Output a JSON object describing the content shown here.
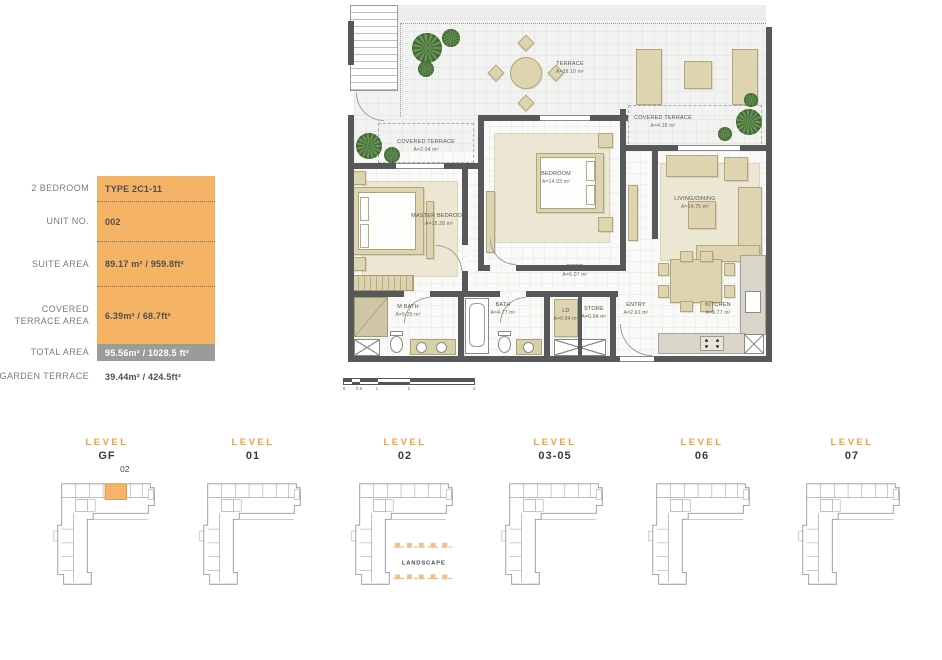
{
  "colors": {
    "table_orange": "#F5B365",
    "total_gray": "#9B9B9B",
    "wall": "#57585A",
    "furniture": "#DED5B0",
    "level_title_orange": "#EBA23B",
    "keyplan_outline": "#8E99AA",
    "highlight_unit": "#F4B56A"
  },
  "spec_table": {
    "rows": [
      {
        "label": "2 BEDROOM",
        "value": "TYPE 2C1-11"
      },
      {
        "label": "UNIT NO.",
        "value": "002"
      },
      {
        "label": "SUITE AREA",
        "value": "89.17 m² / 959.8ft²"
      },
      {
        "label": "COVERED TERRACE AREA",
        "value": "6.39m² / 68.7ft²"
      },
      {
        "label": "TOTAL AREA",
        "value": "95.56m² / 1028.5 ft²"
      },
      {
        "label": "GARDEN TERRACE",
        "value": "39.44m² / 424.5ft²"
      }
    ]
  },
  "floor_plan": {
    "rooms": [
      {
        "name": "TERRACE",
        "area": "A=38.10 m²"
      },
      {
        "name": "COVERED TERRACE",
        "area": "A=2.04 m²"
      },
      {
        "name": "COVERED TERRACE",
        "area": "A=4.35 m²"
      },
      {
        "name": "MASTER BEDROOM",
        "area": "A=15.28 m²"
      },
      {
        "name": "BEDROOM",
        "area": "A=14.03 m²"
      },
      {
        "name": "LIVING/DINING",
        "area": "A=14.75 m²"
      },
      {
        "name": "CORR",
        "area": "A=6.07 m²"
      },
      {
        "name": "M BATH",
        "area": "A=5.25 m²"
      },
      {
        "name": "BATH",
        "area": "A=4.77 m²"
      },
      {
        "name": "LD",
        "area": "A=0.94 m²"
      },
      {
        "name": "STORE",
        "area": "A=0.94 m²"
      },
      {
        "name": "ENTRY",
        "area": "A=2.61 m²"
      },
      {
        "name": "KITCHEN",
        "area": "A=9.77 m²"
      }
    ],
    "scale_ticks": [
      "0",
      "0.5",
      "1",
      "2",
      "4"
    ]
  },
  "levels": [
    {
      "title": "LEVEL",
      "number": "GF",
      "unit": "02"
    },
    {
      "title": "LEVEL",
      "number": "01"
    },
    {
      "title": "LEVEL",
      "number": "02",
      "landscape": "LANDSCAPE"
    },
    {
      "title": "LEVEL",
      "number": "03-05"
    },
    {
      "title": "LEVEL",
      "number": "06"
    },
    {
      "title": "LEVEL",
      "number": "07"
    }
  ]
}
